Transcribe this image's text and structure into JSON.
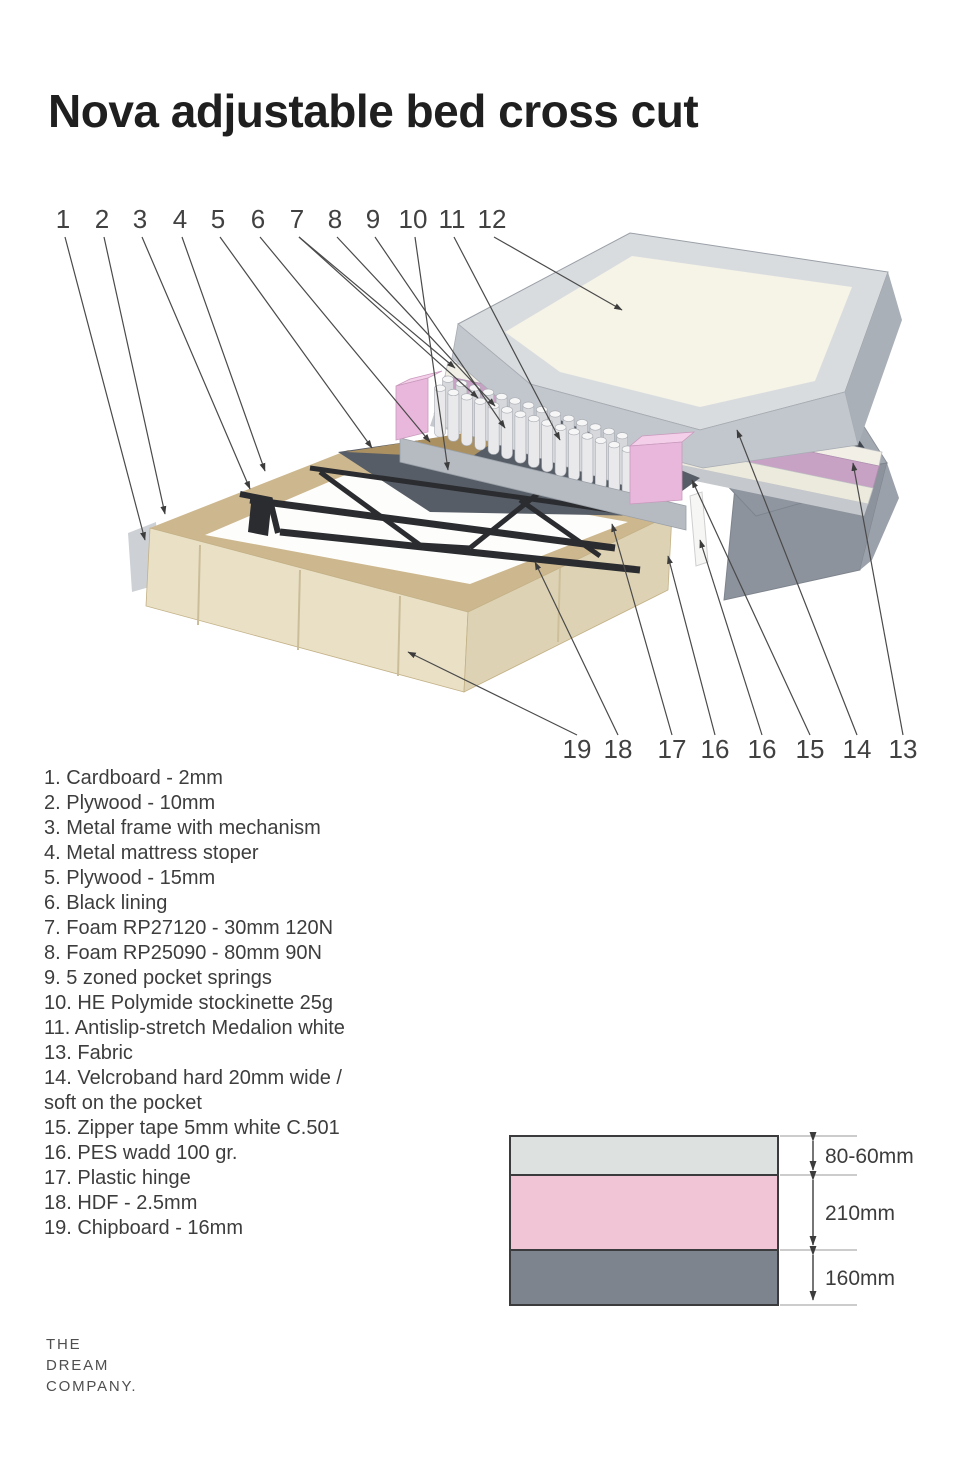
{
  "title": "Nova adjustable bed cross cut",
  "callouts": {
    "top": [
      "1",
      "2",
      "3",
      "4",
      "5",
      "6",
      "7",
      "8",
      "9",
      "10",
      "11",
      "12"
    ],
    "bottom": [
      "19",
      "18",
      "17",
      "16",
      "16",
      "15",
      "14",
      "13"
    ]
  },
  "legend": {
    "items": [
      "1. Cardboard - 2mm",
      "2. Plywood - 10mm",
      "3. Metal frame with mechanism",
      "4. Metal mattress stoper",
      "5. Plywood - 15mm",
      "6. Black lining",
      "7. Foam RP27120 - 30mm 120N",
      "8. Foam RP25090 - 80mm 90N",
      "9. 5 zoned pocket springs",
      "10. HE Polymide stockinette 25g",
      "11. Antislip-stretch Medalion white",
      "13. Fabric",
      "14. Velcroband hard 20mm wide /\nsoft on the pocket",
      "15. Zipper tape 5mm white C.501",
      "16. PES wadd 100 gr.",
      "17. Plastic hinge",
      "18. HDF - 2.5mm",
      "19. Chipboard - 16mm"
    ]
  },
  "layer_diagram": {
    "layers": [
      {
        "name": "top comfort layer",
        "color": "#dde2e0",
        "dimension": "80-60mm"
      },
      {
        "name": "spring core layer",
        "color": "#f1c4d6",
        "dimension": "210mm"
      },
      {
        "name": "base layer",
        "color": "#7e848d",
        "dimension": "160mm"
      }
    ],
    "border_color": "#3b3b3e"
  },
  "logo": {
    "lines": [
      "THE",
      "DREAM",
      "COMPANY."
    ]
  },
  "colors": {
    "pink_foam_block": "#e9b7dc",
    "pink_stripe": "#c7a2c5",
    "mattress_cream": "#f6f3e7",
    "frame_gray": "#a3a9b1",
    "wood_light": "#e9e0c6",
    "wood_rim": "#cdb78e",
    "metal_dark": "#2a2c30",
    "callout_line": "#4a4a4a"
  }
}
